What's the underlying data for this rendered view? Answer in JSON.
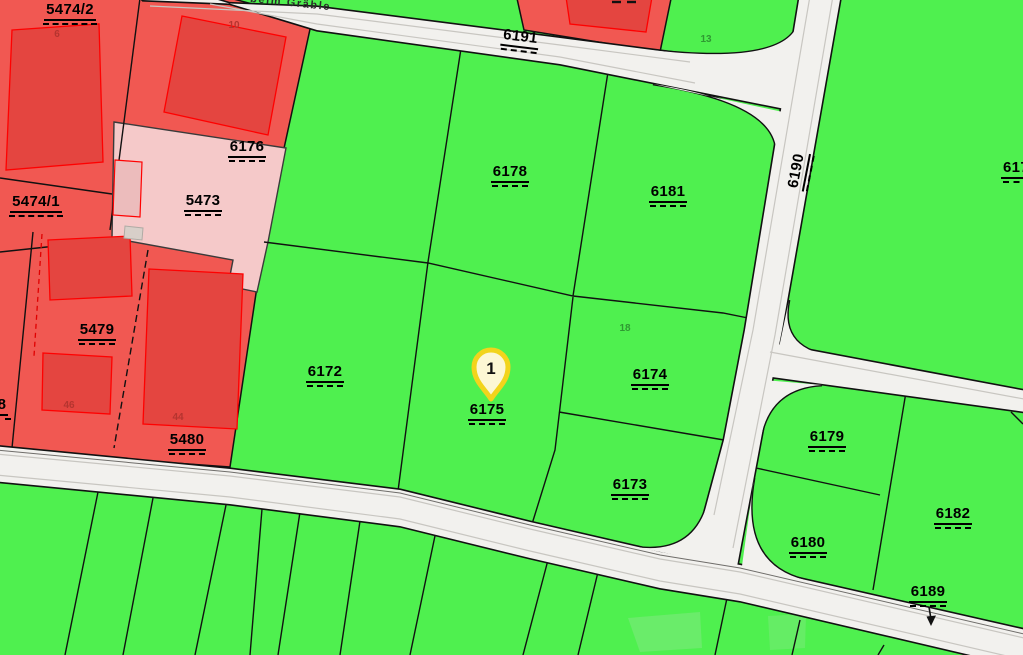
{
  "map": {
    "street": {
      "name": "beim Gräble",
      "x": 250,
      "y": -3,
      "rot": 6
    },
    "marker": {
      "number": "1",
      "x": 491,
      "y": 372
    },
    "colors": {
      "green": "#4ff04f",
      "red_parcel": "#f15852",
      "red_building": "#e44540",
      "building_outline": "#ff0000",
      "pink_parcel": "#f5c9c9",
      "pink_building": "#ecbcbc",
      "road_fill": "#f2f1ee",
      "road_inner_line": "#c8c6c1",
      "casing": "#111111",
      "marker_ring": "#f2d41c",
      "marker_fill": "#fcf7d4",
      "house_number_red": "#b5342f",
      "house_number_green": "#2f9932"
    },
    "parcel_labels": [
      {
        "text": "5474/2",
        "x": 70,
        "y": 2,
        "rot": 0
      },
      {
        "text": "5474/1",
        "x": 36,
        "y": 194,
        "rot": 0
      },
      {
        "text": "5473",
        "x": 203,
        "y": 193,
        "rot": 0
      },
      {
        "text": "5479",
        "x": 97,
        "y": 322,
        "rot": 0
      },
      {
        "text": "5480",
        "x": 187,
        "y": 432,
        "rot": 0
      },
      {
        "text": "8",
        "x": 2,
        "y": 397,
        "rot": 0
      },
      {
        "text": "6176",
        "x": 247,
        "y": 139,
        "rot": 0
      },
      {
        "text": "6178",
        "x": 510,
        "y": 164,
        "rot": 0
      },
      {
        "text": "6181",
        "x": 668,
        "y": 184,
        "rot": 0
      },
      {
        "text": "6172",
        "x": 325,
        "y": 364,
        "rot": 0
      },
      {
        "text": "6175",
        "x": 487,
        "y": 402,
        "rot": 0
      },
      {
        "text": "6174",
        "x": 650,
        "y": 367,
        "rot": 0
      },
      {
        "text": "6173",
        "x": 630,
        "y": 477,
        "rot": 0
      },
      {
        "text": "6179",
        "x": 827,
        "y": 429,
        "rot": 0
      },
      {
        "text": "6180",
        "x": 808,
        "y": 535,
        "rot": 0
      },
      {
        "text": "6182",
        "x": 953,
        "y": 506,
        "rot": 0
      },
      {
        "text": "6189",
        "x": 928,
        "y": 584,
        "rot": 0
      },
      {
        "text": "617",
        "x": 1016,
        "y": 160,
        "rot": 0
      },
      {
        "text": "6191",
        "x": 520,
        "y": 29,
        "rot": 7
      },
      {
        "text": "6190",
        "x": 800,
        "y": 160,
        "rot": -79
      }
    ],
    "house_numbers": [
      {
        "text": "6",
        "x": 57,
        "y": 30,
        "color": "red"
      },
      {
        "text": "10",
        "x": 234,
        "y": 21,
        "color": "red"
      },
      {
        "text": "46",
        "x": 69,
        "y": 401,
        "color": "red"
      },
      {
        "text": "44",
        "x": 178,
        "y": 413,
        "color": "red"
      },
      {
        "text": "13",
        "x": 706,
        "y": 35,
        "color": "green"
      },
      {
        "text": "18",
        "x": 625,
        "y": 324,
        "color": "green"
      }
    ]
  }
}
